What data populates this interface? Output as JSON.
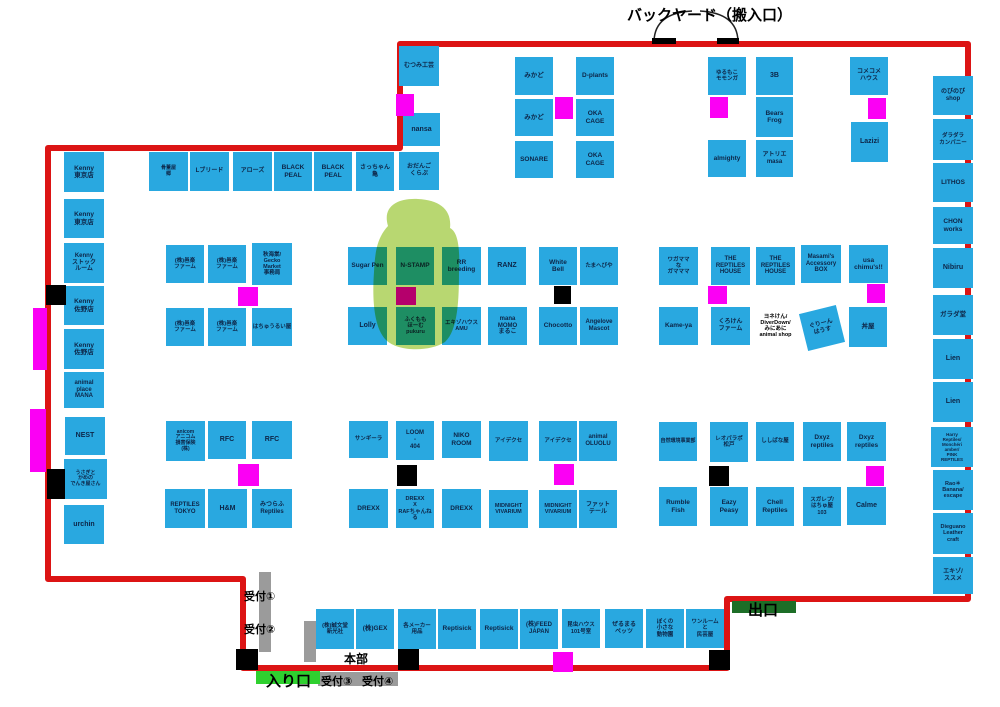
{
  "title": "バックヤード（搬入口）",
  "title_pos": {
    "x": 627,
    "y": 4
  },
  "colors": {
    "booth_fill": "#29a8e0",
    "booth_text": "#0d2547",
    "wall_red": "#dc1414",
    "marker_magenta": "#fb00f4",
    "marker_black": "#000000",
    "reception_gray": "#9b9b9b",
    "entrance_green": "#2fd02f",
    "exit_green": "#1d6e27",
    "highlight_green": "#a9cf52"
  },
  "wall": {
    "path": "M 48 148 L 400 148 L 400 44 L 968 44 L 968 599 L 727 599 L 727 668 L 243 668 L 243 579 L 48 579 Z"
  },
  "doors": {
    "path": "M 692 11 Q 655 13 654 41 M 700 11 Q 737 13 738 41"
  },
  "highlight": {
    "path": "M 388 226 C 382 206 398 198 418 199 C 440 200 452 210 450 228 C 458 232 460 248 459 270 C 459 300 458 330 445 342 C 430 352 398 352 386 340 C 374 328 372 300 374 272 C 375 252 377 238 388 226 Z"
  },
  "booths": [
    {
      "label": "むつみ工芸",
      "x": 399,
      "y": 46,
      "w": 40,
      "h": 40,
      "fs": 6
    },
    {
      "label": "nansa",
      "x": 403,
      "y": 113,
      "w": 37,
      "h": 33,
      "fs": 7
    },
    {
      "label": "骨董屋\n郷",
      "x": 149,
      "y": 152,
      "w": 39,
      "h": 39,
      "fs": 5
    },
    {
      "label": "Lブリード",
      "x": 190,
      "y": 152,
      "w": 39,
      "h": 39,
      "fs": 6
    },
    {
      "label": "アローズ",
      "x": 233,
      "y": 152,
      "w": 39,
      "h": 39,
      "fs": 6
    },
    {
      "label": "BLACK\nPEAL",
      "x": 274,
      "y": 152,
      "w": 38,
      "h": 39,
      "fs": 6.5
    },
    {
      "label": "BLACK\nPEAL",
      "x": 314,
      "y": 152,
      "w": 38,
      "h": 39,
      "fs": 6.5
    },
    {
      "label": "さっちゃん\n亀",
      "x": 356,
      "y": 152,
      "w": 38,
      "h": 39,
      "fs": 6
    },
    {
      "label": "おだんご\nくらぶ",
      "x": 399,
      "y": 152,
      "w": 40,
      "h": 38,
      "fs": 6
    },
    {
      "label": "みかど",
      "x": 515,
      "y": 57,
      "w": 38,
      "h": 38,
      "fs": 6.5
    },
    {
      "label": "D-plants",
      "x": 576,
      "y": 57,
      "w": 38,
      "h": 38,
      "fs": 6.5
    },
    {
      "label": "みかど",
      "x": 515,
      "y": 99,
      "w": 38,
      "h": 37,
      "fs": 6.5
    },
    {
      "label": "OKA\nCAGE",
      "x": 576,
      "y": 99,
      "w": 38,
      "h": 37,
      "fs": 6.5
    },
    {
      "label": "SONARE",
      "x": 515,
      "y": 141,
      "w": 38,
      "h": 37,
      "fs": 6.5
    },
    {
      "label": "OKA\nCAGE",
      "x": 576,
      "y": 141,
      "w": 38,
      "h": 37,
      "fs": 6.5
    },
    {
      "label": "ゆるもこ\nモモンガ",
      "x": 708,
      "y": 57,
      "w": 38,
      "h": 38,
      "fs": 5.5
    },
    {
      "label": "3B",
      "x": 756,
      "y": 57,
      "w": 37,
      "h": 38,
      "fs": 7
    },
    {
      "label": "Bears\nFrog",
      "x": 756,
      "y": 97,
      "w": 37,
      "h": 40,
      "fs": 6.5
    },
    {
      "label": "almighty",
      "x": 708,
      "y": 140,
      "w": 38,
      "h": 37,
      "fs": 6.5
    },
    {
      "label": "アトリエ\nmasa",
      "x": 756,
      "y": 140,
      "w": 37,
      "h": 37,
      "fs": 6
    },
    {
      "label": "コメコメ\nハウス",
      "x": 850,
      "y": 57,
      "w": 38,
      "h": 38,
      "fs": 6
    },
    {
      "label": "Lazizi",
      "x": 851,
      "y": 122,
      "w": 37,
      "h": 40,
      "fs": 7
    },
    {
      "label": "Kenny\n東京店",
      "x": 64,
      "y": 152,
      "w": 40,
      "h": 40,
      "fs": 6.5
    },
    {
      "label": "Kenny\n東京店",
      "x": 64,
      "y": 199,
      "w": 40,
      "h": 39,
      "fs": 6.5
    },
    {
      "label": "Kenny\nストック\nルーム",
      "x": 64,
      "y": 243,
      "w": 40,
      "h": 40,
      "fs": 6
    },
    {
      "label": "Kenny\n佐野店",
      "x": 64,
      "y": 286,
      "w": 40,
      "h": 39,
      "fs": 6.5
    },
    {
      "label": "Kenny\n佐野店",
      "x": 64,
      "y": 329,
      "w": 40,
      "h": 40,
      "fs": 6.5
    },
    {
      "label": "animal\nplace\nMANA",
      "x": 64,
      "y": 372,
      "w": 40,
      "h": 36,
      "fs": 6
    },
    {
      "label": "NEST",
      "x": 65,
      "y": 417,
      "w": 40,
      "h": 38,
      "fs": 7
    },
    {
      "label": "うさぎと\nかめの\nでんき屋さん",
      "x": 64,
      "y": 459,
      "w": 43,
      "h": 40,
      "fs": 5
    },
    {
      "label": "urchin",
      "x": 64,
      "y": 505,
      "w": 40,
      "h": 39,
      "fs": 7
    },
    {
      "label": "のびのび\nshop",
      "x": 933,
      "y": 76,
      "w": 40,
      "h": 39,
      "fs": 6
    },
    {
      "label": "ダラダラ\nカンパニー",
      "x": 933,
      "y": 119,
      "w": 40,
      "h": 41,
      "fs": 5.5
    },
    {
      "label": "LITHOS",
      "x": 933,
      "y": 163,
      "w": 40,
      "h": 39,
      "fs": 6.5
    },
    {
      "label": "CHON\nworks",
      "x": 933,
      "y": 207,
      "w": 40,
      "h": 37,
      "fs": 6.5
    },
    {
      "label": "Nibiru",
      "x": 933,
      "y": 248,
      "w": 40,
      "h": 40,
      "fs": 7
    },
    {
      "label": "ガラダ堂",
      "x": 933,
      "y": 295,
      "w": 40,
      "h": 40,
      "fs": 6.5
    },
    {
      "label": "Lien",
      "x": 933,
      "y": 339,
      "w": 40,
      "h": 40,
      "fs": 7
    },
    {
      "label": "Lien",
      "x": 933,
      "y": 382,
      "w": 40,
      "h": 40,
      "fs": 7
    },
    {
      "label": "Harry\nReptiles/\nMonchéri\namber/\nPINK\nREPTILES",
      "x": 931,
      "y": 427,
      "w": 42,
      "h": 40,
      "fs": 4.5
    },
    {
      "label": "Rao＊\nBanana/\nescape",
      "x": 933,
      "y": 470,
      "w": 40,
      "h": 40,
      "fs": 5.5
    },
    {
      "label": "Dieguano\nLeather\ncraft",
      "x": 933,
      "y": 513,
      "w": 40,
      "h": 41,
      "fs": 5.5
    },
    {
      "label": "エキゾ/\nススメ",
      "x": 933,
      "y": 557,
      "w": 40,
      "h": 37,
      "fs": 6
    },
    {
      "label": "(株)邑楽\nファーム",
      "x": 166,
      "y": 245,
      "w": 38,
      "h": 38,
      "fs": 5.5
    },
    {
      "label": "(株)邑楽\nファーム",
      "x": 208,
      "y": 245,
      "w": 38,
      "h": 38,
      "fs": 5.5
    },
    {
      "label": "秋海棠/\nGecko\nMarket\n事務局",
      "x": 252,
      "y": 243,
      "w": 40,
      "h": 42,
      "fs": 5.5
    },
    {
      "label": "(株)邑楽\nファーム",
      "x": 166,
      "y": 308,
      "w": 38,
      "h": 38,
      "fs": 5.5
    },
    {
      "label": "(株)邑楽\nファーム",
      "x": 208,
      "y": 308,
      "w": 38,
      "h": 38,
      "fs": 5.5
    },
    {
      "label": "はちゅうるい屋",
      "x": 252,
      "y": 308,
      "w": 40,
      "h": 38,
      "fs": 5.5
    },
    {
      "label": "Sugar Pen",
      "x": 348,
      "y": 247,
      "w": 39,
      "h": 38,
      "fs": 6.5
    },
    {
      "label": "N-STAMP",
      "x": 396,
      "y": 247,
      "w": 38,
      "h": 38,
      "fs": 6.5
    },
    {
      "label": "RR\nbreeding",
      "x": 442,
      "y": 247,
      "w": 39,
      "h": 38,
      "fs": 6.5
    },
    {
      "label": "Lolly",
      "x": 348,
      "y": 307,
      "w": 39,
      "h": 38,
      "fs": 7
    },
    {
      "label": "ふくもも\nほーむ\npukuru",
      "x": 396,
      "y": 307,
      "w": 39,
      "h": 38,
      "fs": 5.5
    },
    {
      "label": "エキゾハウス\nAMU",
      "x": 442,
      "y": 307,
      "w": 39,
      "h": 38,
      "fs": 5.5
    },
    {
      "label": "RANZ",
      "x": 488,
      "y": 247,
      "w": 38,
      "h": 38,
      "fs": 7
    },
    {
      "label": "White\nBell",
      "x": 539,
      "y": 247,
      "w": 38,
      "h": 38,
      "fs": 6.5
    },
    {
      "label": "たまへびや",
      "x": 580,
      "y": 247,
      "w": 38,
      "h": 38,
      "fs": 5.5
    },
    {
      "label": "mana\nMOMO\nまるこ",
      "x": 488,
      "y": 307,
      "w": 39,
      "h": 38,
      "fs": 6
    },
    {
      "label": "Chocotto",
      "x": 539,
      "y": 307,
      "w": 38,
      "h": 38,
      "fs": 6.5
    },
    {
      "label": "Angelove\nMascot",
      "x": 580,
      "y": 307,
      "w": 38,
      "h": 38,
      "fs": 6
    },
    {
      "label": "ワガママ\nな\nガマママ",
      "x": 659,
      "y": 247,
      "w": 39,
      "h": 38,
      "fs": 5.5
    },
    {
      "label": "THE\nREPTILES\nHOUSE",
      "x": 711,
      "y": 247,
      "w": 39,
      "h": 38,
      "fs": 6
    },
    {
      "label": "THE\nREPTILES\nHOUSE",
      "x": 756,
      "y": 247,
      "w": 39,
      "h": 38,
      "fs": 6
    },
    {
      "label": "Masami's\nAccessory\nBOX",
      "x": 801,
      "y": 245,
      "w": 40,
      "h": 38,
      "fs": 6
    },
    {
      "label": "usa\nchimu's!!",
      "x": 849,
      "y": 245,
      "w": 39,
      "h": 38,
      "fs": 6.5
    },
    {
      "label": "Kame-ya",
      "x": 659,
      "y": 307,
      "w": 39,
      "h": 38,
      "fs": 6.5
    },
    {
      "label": "くろけん\nファーム",
      "x": 711,
      "y": 307,
      "w": 39,
      "h": 38,
      "fs": 6
    },
    {
      "label": "ヨネけん/\nDiverDown/\nみにあに\nanimal shop",
      "x": 752,
      "y": 299,
      "w": 47,
      "h": 54,
      "fs": 5.5,
      "white": true
    },
    {
      "label": "ぐりーん\nはうす",
      "x": 803,
      "y": 309,
      "w": 38,
      "h": 38,
      "fs": 6,
      "rot": -14
    },
    {
      "label": "丼屋",
      "x": 849,
      "y": 307,
      "w": 38,
      "h": 40,
      "fs": 6.5
    },
    {
      "label": "anicom\nアニコム\n損害保険\n(株)",
      "x": 166,
      "y": 421,
      "w": 39,
      "h": 40,
      "fs": 5
    },
    {
      "label": "RFC",
      "x": 208,
      "y": 421,
      "w": 38,
      "h": 38,
      "fs": 7
    },
    {
      "label": "RFC",
      "x": 252,
      "y": 421,
      "w": 40,
      "h": 38,
      "fs": 7
    },
    {
      "label": "REPTILES\nTOKYO",
      "x": 165,
      "y": 489,
      "w": 40,
      "h": 39,
      "fs": 6
    },
    {
      "label": "H&M",
      "x": 208,
      "y": 489,
      "w": 39,
      "h": 39,
      "fs": 7
    },
    {
      "label": "みつらふ\nReptiles",
      "x": 252,
      "y": 489,
      "w": 40,
      "h": 39,
      "fs": 6
    },
    {
      "label": "サンギーラ",
      "x": 349,
      "y": 421,
      "w": 39,
      "h": 37,
      "fs": 5.5
    },
    {
      "label": "LOOM\n-\n404",
      "x": 396,
      "y": 421,
      "w": 38,
      "h": 39,
      "fs": 6
    },
    {
      "label": "NIKO\nROOM",
      "x": 442,
      "y": 421,
      "w": 39,
      "h": 37,
      "fs": 6.5
    },
    {
      "label": "DREXX",
      "x": 349,
      "y": 489,
      "w": 39,
      "h": 39,
      "fs": 6.5
    },
    {
      "label": "DREXX\nX\nRAFちゃんねる",
      "x": 396,
      "y": 489,
      "w": 38,
      "h": 39,
      "fs": 5.5
    },
    {
      "label": "DREXX",
      "x": 442,
      "y": 489,
      "w": 39,
      "h": 39,
      "fs": 6.5
    },
    {
      "label": "アイデクセ",
      "x": 489,
      "y": 421,
      "w": 39,
      "h": 40,
      "fs": 5.5
    },
    {
      "label": "アイデクセ",
      "x": 539,
      "y": 421,
      "w": 38,
      "h": 40,
      "fs": 5.5
    },
    {
      "label": "animal\nOLUOLU",
      "x": 579,
      "y": 421,
      "w": 38,
      "h": 40,
      "fs": 6
    },
    {
      "label": "MIDNIGHT\nVIVARIUM",
      "x": 489,
      "y": 490,
      "w": 39,
      "h": 38,
      "fs": 5.5
    },
    {
      "label": "MIDNIGHT\nVIVARIUM",
      "x": 539,
      "y": 490,
      "w": 38,
      "h": 38,
      "fs": 5.5
    },
    {
      "label": "ファット\nテール",
      "x": 579,
      "y": 490,
      "w": 38,
      "h": 38,
      "fs": 6
    },
    {
      "label": "自然環境事業部",
      "x": 659,
      "y": 422,
      "w": 38,
      "h": 39,
      "fs": 5
    },
    {
      "label": "レオパラボ\n松戸",
      "x": 710,
      "y": 422,
      "w": 38,
      "h": 40,
      "fs": 5.5
    },
    {
      "label": "ししばな屋",
      "x": 756,
      "y": 422,
      "w": 38,
      "h": 39,
      "fs": 5.5
    },
    {
      "label": "Dxyz\nreptiles",
      "x": 803,
      "y": 422,
      "w": 38,
      "h": 39,
      "fs": 6.5
    },
    {
      "label": "Dxyz\nreptiles",
      "x": 847,
      "y": 422,
      "w": 39,
      "h": 39,
      "fs": 6.5
    },
    {
      "label": "Rumble\nFish",
      "x": 659,
      "y": 487,
      "w": 38,
      "h": 39,
      "fs": 6.5
    },
    {
      "label": "Eazy\nPeasy",
      "x": 710,
      "y": 487,
      "w": 38,
      "h": 39,
      "fs": 6.5
    },
    {
      "label": "Chell\nReptiles",
      "x": 756,
      "y": 487,
      "w": 38,
      "h": 39,
      "fs": 6.5
    },
    {
      "label": "スガレプ/\nはちゅ屋\n103",
      "x": 803,
      "y": 487,
      "w": 38,
      "h": 39,
      "fs": 5.5
    },
    {
      "label": "Calme",
      "x": 847,
      "y": 487,
      "w": 39,
      "h": 38,
      "fs": 7
    },
    {
      "label": "(株)誠文堂\n新光社",
      "x": 316,
      "y": 609,
      "w": 38,
      "h": 40,
      "fs": 5.5
    },
    {
      "label": "(株)GEX",
      "x": 356,
      "y": 609,
      "w": 38,
      "h": 40,
      "fs": 6.5
    },
    {
      "label": "各メーカー\n用品",
      "x": 398,
      "y": 609,
      "w": 38,
      "h": 40,
      "fs": 5.5
    },
    {
      "label": "Reptisick",
      "x": 438,
      "y": 609,
      "w": 38,
      "h": 40,
      "fs": 6.5
    },
    {
      "label": "Reptisick",
      "x": 480,
      "y": 609,
      "w": 38,
      "h": 40,
      "fs": 6.5
    },
    {
      "label": "(株)FEED\nJAPAN",
      "x": 520,
      "y": 609,
      "w": 38,
      "h": 40,
      "fs": 6
    },
    {
      "label": "昆虫ハウス\n101号室",
      "x": 562,
      "y": 609,
      "w": 38,
      "h": 39,
      "fs": 5.5
    },
    {
      "label": "ぜるまる\nペッツ",
      "x": 605,
      "y": 609,
      "w": 38,
      "h": 39,
      "fs": 6
    },
    {
      "label": "ぼくの\n小さな\n動物園",
      "x": 646,
      "y": 609,
      "w": 38,
      "h": 39,
      "fs": 5.5
    },
    {
      "label": "ワンルーム\nと\n民芸屋",
      "x": 686,
      "y": 609,
      "w": 38,
      "h": 39,
      "fs": 5.5
    }
  ],
  "rects": [
    {
      "x": 396,
      "y": 94,
      "w": 18,
      "h": 22,
      "c": "magenta"
    },
    {
      "x": 555,
      "y": 97,
      "w": 18,
      "h": 22,
      "c": "magenta"
    },
    {
      "x": 710,
      "y": 97,
      "w": 18,
      "h": 21,
      "c": "magenta"
    },
    {
      "x": 868,
      "y": 98,
      "w": 18,
      "h": 21,
      "c": "magenta"
    },
    {
      "x": 238,
      "y": 287,
      "w": 20,
      "h": 19,
      "c": "magenta"
    },
    {
      "x": 396,
      "y": 287,
      "w": 20,
      "h": 18,
      "c": "magenta"
    },
    {
      "x": 708,
      "y": 286,
      "w": 19,
      "h": 18,
      "c": "magenta"
    },
    {
      "x": 867,
      "y": 284,
      "w": 18,
      "h": 19,
      "c": "magenta"
    },
    {
      "x": 238,
      "y": 464,
      "w": 21,
      "h": 22,
      "c": "magenta"
    },
    {
      "x": 554,
      "y": 464,
      "w": 20,
      "h": 21,
      "c": "magenta"
    },
    {
      "x": 866,
      "y": 466,
      "w": 18,
      "h": 20,
      "c": "magenta"
    },
    {
      "x": 553,
      "y": 652,
      "w": 20,
      "h": 20,
      "c": "magenta"
    },
    {
      "x": 33,
      "y": 308,
      "w": 14,
      "h": 62,
      "c": "magenta"
    },
    {
      "x": 30,
      "y": 409,
      "w": 16,
      "h": 63,
      "c": "magenta"
    },
    {
      "x": 46,
      "y": 285,
      "w": 20,
      "h": 20,
      "c": "black"
    },
    {
      "x": 47,
      "y": 469,
      "w": 18,
      "h": 30,
      "c": "black"
    },
    {
      "x": 554,
      "y": 286,
      "w": 17,
      "h": 18,
      "c": "black"
    },
    {
      "x": 397,
      "y": 465,
      "w": 20,
      "h": 21,
      "c": "black"
    },
    {
      "x": 709,
      "y": 466,
      "w": 20,
      "h": 20,
      "c": "black"
    },
    {
      "x": 236,
      "y": 649,
      "w": 22,
      "h": 21,
      "c": "black"
    },
    {
      "x": 398,
      "y": 649,
      "w": 21,
      "h": 21,
      "c": "black"
    },
    {
      "x": 709,
      "y": 650,
      "w": 21,
      "h": 20,
      "c": "black"
    },
    {
      "x": 652,
      "y": 38,
      "w": 24,
      "h": 6,
      "c": "black"
    },
    {
      "x": 717,
      "y": 38,
      "w": 22,
      "h": 6,
      "c": "black"
    },
    {
      "x": 259,
      "y": 572,
      "w": 12,
      "h": 80,
      "c": "gray"
    },
    {
      "x": 304,
      "y": 621,
      "w": 12,
      "h": 41,
      "c": "gray"
    },
    {
      "x": 318,
      "y": 672,
      "w": 80,
      "h": 14,
      "c": "gray"
    },
    {
      "x": 256,
      "y": 671,
      "w": 64,
      "h": 13,
      "c": "green-bright"
    },
    {
      "x": 732,
      "y": 601,
      "w": 64,
      "h": 12,
      "c": "green-dark"
    }
  ],
  "labels": [
    {
      "text": "受付①",
      "x": 244,
      "y": 588,
      "fs": 11
    },
    {
      "text": "受付②",
      "x": 244,
      "y": 621,
      "fs": 11
    },
    {
      "text": "受付③",
      "x": 321,
      "y": 673,
      "fs": 11
    },
    {
      "text": "受付④",
      "x": 362,
      "y": 673,
      "fs": 11
    },
    {
      "text": "本部",
      "x": 344,
      "y": 650,
      "fs": 12
    },
    {
      "text": "入り口",
      "x": 266,
      "y": 670,
      "fs": 15
    },
    {
      "text": "出口",
      "x": 748,
      "y": 599,
      "fs": 15
    }
  ]
}
